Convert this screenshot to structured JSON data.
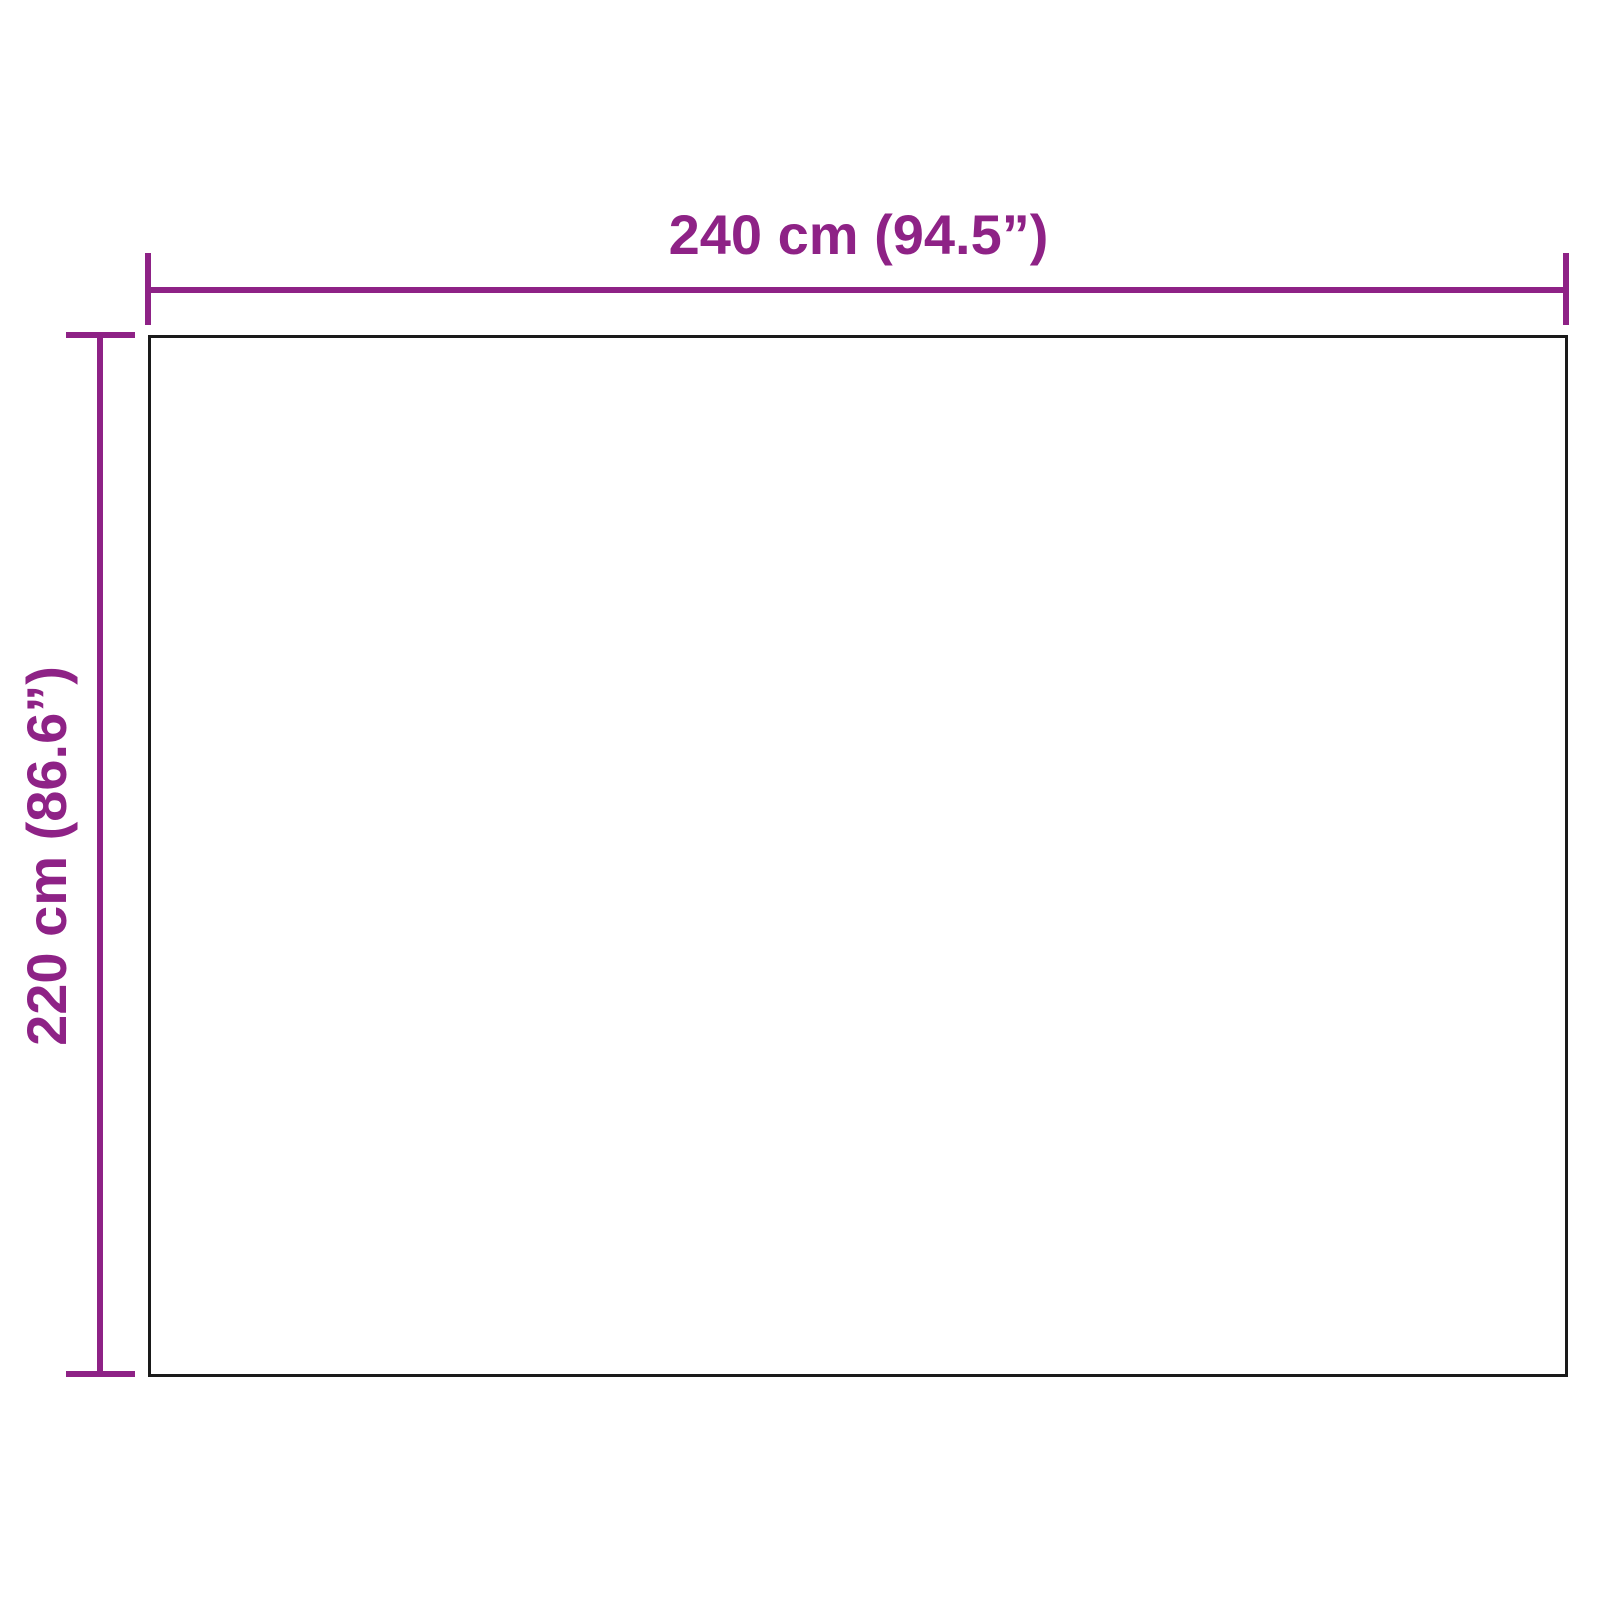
{
  "diagram": {
    "type": "product-dimension-diagram",
    "width_label": "240 cm (94.5”)",
    "height_label": "220 cm (86.6”)",
    "width_value_cm": 240,
    "width_value_inch": 94.5,
    "height_value_cm": 220,
    "height_value_inch": 86.6,
    "accent_color": "#8e2286",
    "outline_color": "#1a1a1a",
    "background_color": "#ffffff"
  }
}
